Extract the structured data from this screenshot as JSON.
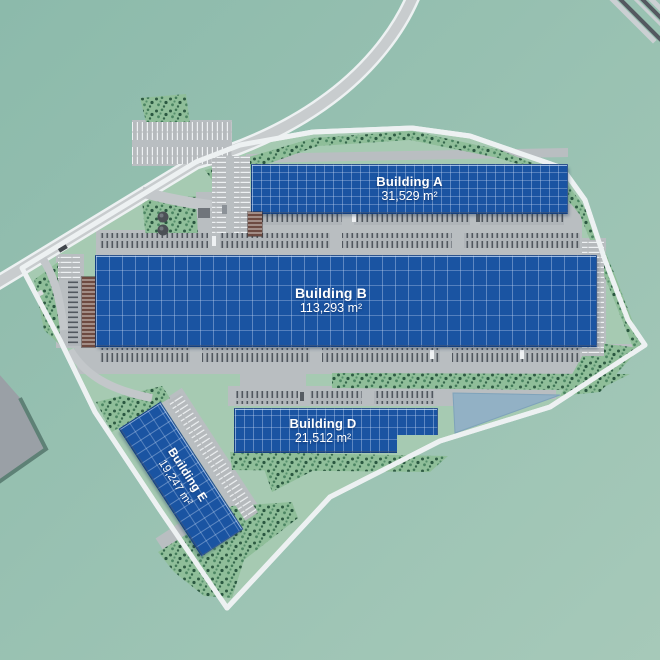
{
  "map": {
    "buildings": [
      {
        "name": "Building A",
        "area": "31,529 m²"
      },
      {
        "name": "Building B",
        "area": "113,293 m²"
      },
      {
        "name": "Building D",
        "area": "21,512 m²"
      },
      {
        "name": "Building E",
        "area": "19,247 m²"
      }
    ]
  },
  "colors": {
    "bg_top": "#8cbaab",
    "bg_bottom": "#a6c9b9",
    "site_green": "#a6cab2",
    "roof_blue": "#1a54a2",
    "pond_blue": "#92b1c5",
    "paving": "#b9bec1",
    "road_gray": "#c8ccce",
    "road_white": "#edf1f2",
    "tree_green": "#2e5b43",
    "label_white": "#ffffff"
  }
}
